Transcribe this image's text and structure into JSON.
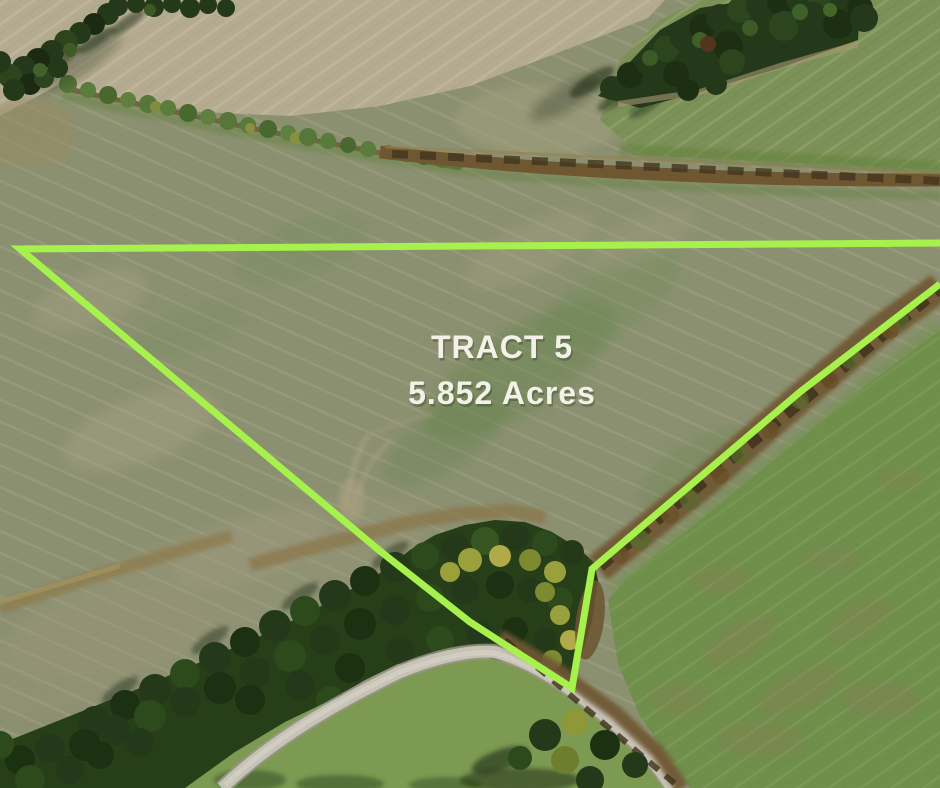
{
  "label": {
    "line1": "TRACT 5",
    "line2": "5.852 Acres"
  },
  "boundary": {
    "points": "940,243 20,249 380,551 470,622 572,688 592,569 800,392 940,284",
    "color": "#a7f14c",
    "stroke_width": "7"
  },
  "palette": {
    "field_tan": "#b5ab90",
    "field_central": "#8b9071",
    "field_top_right": "#7c9158",
    "field_bottom_right": "#6f8f4b",
    "lawn": "#7c9a52",
    "road": "#c6c2b6",
    "tree_dark": "#24381a",
    "tree_mid": "#33511f",
    "tree_autumn": "#9aa13c",
    "hedge_green": "#57763a",
    "brush_brown": "#6f5731",
    "label_text": "#f4f1e8"
  }
}
